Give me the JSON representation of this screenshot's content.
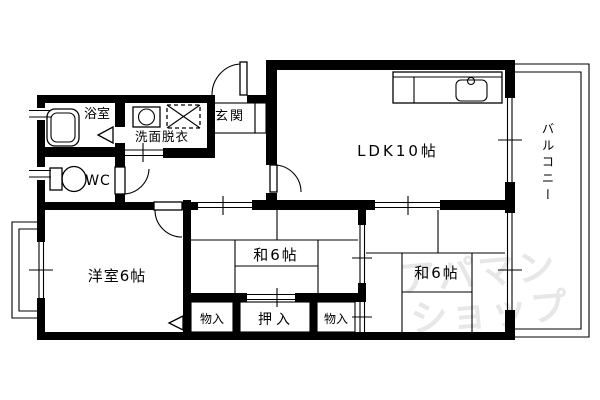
{
  "floorplan": {
    "rooms": {
      "bath": "浴室",
      "washroom": "洗面脱衣",
      "entrance": "玄関",
      "wc": "WC",
      "ldk": "LDK10帖",
      "western": "洋室6帖",
      "japanese_center": "和6帖",
      "japanese_right": "和6帖",
      "closet_left": "物入",
      "oshiire": "押入",
      "closet_right": "物入",
      "balcony": "バルコニー"
    },
    "watermark": {
      "line1": "アパマン",
      "line2": "ショップ"
    },
    "colors": {
      "line": "#000000",
      "background": "#ffffff",
      "watermark": "#e7e7e7"
    }
  }
}
